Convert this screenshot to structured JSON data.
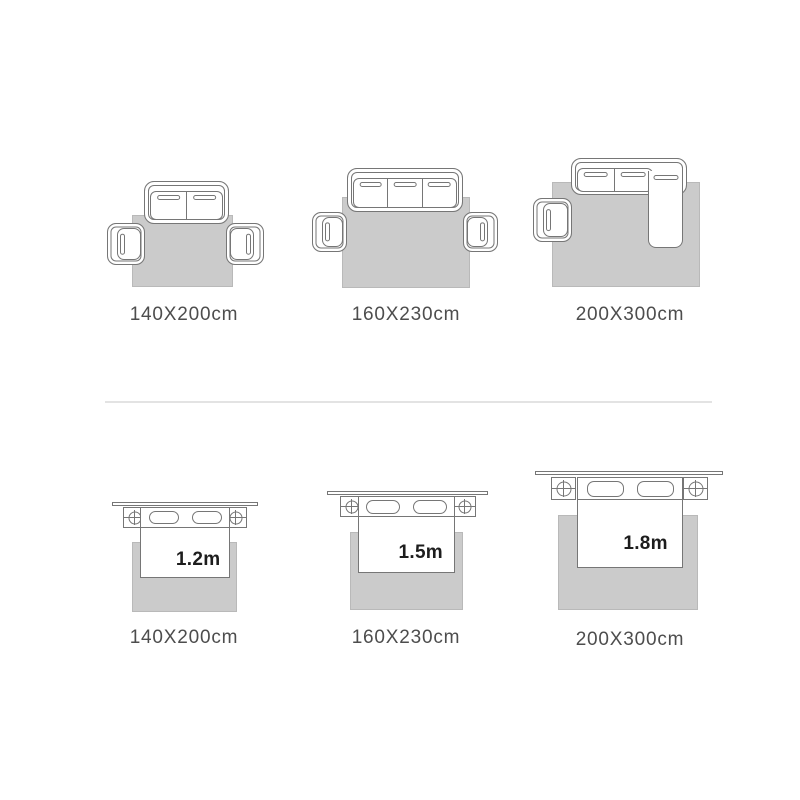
{
  "colors": {
    "background": "#ffffff",
    "line": "#767676",
    "rug_fill": "#cbcbcb",
    "label_text": "#4d4d4d",
    "size_text": "#1d1d1d",
    "divider": "#e3e3e3"
  },
  "top_row": {
    "items": [
      {
        "rug_size_label": "140X200cm",
        "scene": "two-seat-sofa-with-two-armchairs-on-rug"
      },
      {
        "rug_size_label": "160X230cm",
        "scene": "three-seat-sofa-with-two-armchairs-on-rug"
      },
      {
        "rug_size_label": "200X300cm",
        "scene": "sectional-sofa-with-one-armchair-on-rug"
      }
    ]
  },
  "bottom_row": {
    "items": [
      {
        "rug_size_label": "140X200cm",
        "bed_width_label": "1.2m",
        "scene": "bed-with-two-nightstands-on-rug"
      },
      {
        "rug_size_label": "160X230cm",
        "bed_width_label": "1.5m",
        "scene": "bed-with-two-nightstands-on-rug"
      },
      {
        "rug_size_label": "200X300cm",
        "bed_width_label": "1.8m",
        "scene": "bed-with-two-nightstands-on-rug"
      }
    ]
  }
}
